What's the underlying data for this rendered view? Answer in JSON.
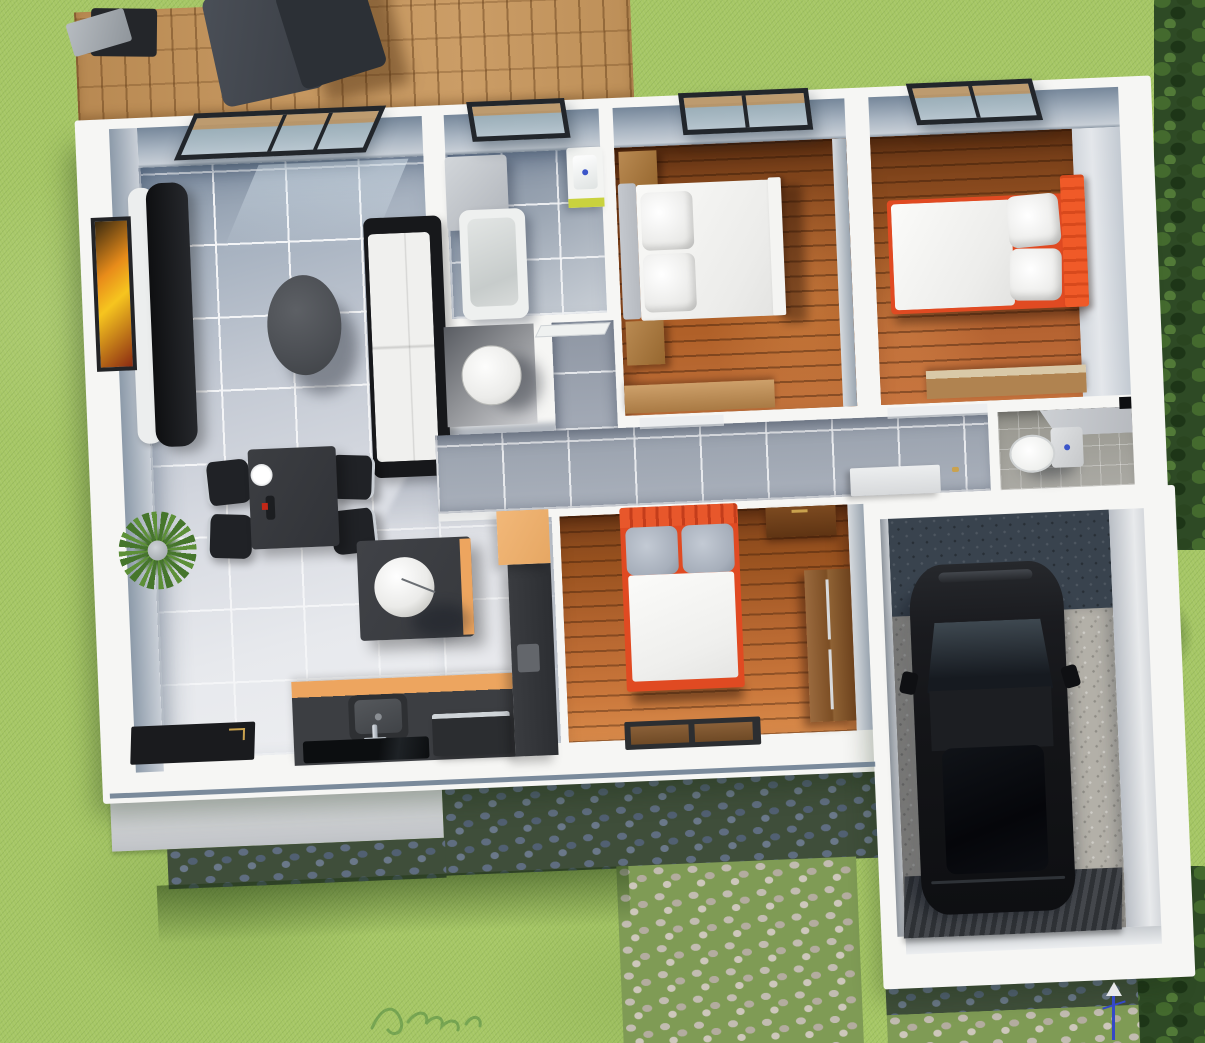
{
  "scene": {
    "kind": "3d-rendered-floor-plan",
    "view": "top-down",
    "watermark": {
      "present": true,
      "legible": false
    }
  },
  "colors": {
    "grass": "#a6c765",
    "grassShadow": "#4f7a33",
    "foliage": "#2e4a25",
    "deck": "#c3955e",
    "wallWhite": "#f6f6f4",
    "wallFace": "#b9c3cd",
    "wallEdge": "#5b6f84",
    "tileLight": "#e9ebee",
    "tileShade": "#8e9cac",
    "tileHall": "#9aa2ae",
    "grout": "#f4f5f7",
    "wood": "#a85a28",
    "woodDark": "#8a4a1f",
    "woodLight": "#cd8443",
    "woodBed3": "#b4652f",
    "furnDark": "#3a3c40",
    "black": "#17181b",
    "sofaWhite": "#f0f0ee",
    "cabinetOrange": "#f2b879",
    "counterOrange": "#eda55f",
    "bedRed": "#e04a22",
    "bedOrange": "#f05a28",
    "pillowGray": "#a7afbb",
    "headboardGray": "#b6bac0",
    "cobbleDarkStone": "#5f6d80",
    "cobbleDarkGap": "#3f4e3a",
    "cobbleLightStone": "#c2bcb1",
    "cobbleLightGap": "#7f9b55",
    "slab": "#d0d2d5",
    "garageDark": "#39434e",
    "gravel": "#b3b0a8",
    "glass": "#9fb3bb",
    "lime": "#c9d23e",
    "plantGreen": "#4e7d32",
    "toiletFloor": "#aaa9a3",
    "carBlack": "#141518"
  },
  "rooms": [
    {
      "name": "living-room",
      "floor": "gray-tile",
      "furniture": [
        "sliding-window",
        "tv-console",
        "media-shelf",
        "wall-art",
        "coffee-table",
        "sofa",
        "potted-plant",
        "floor-mat"
      ]
    },
    {
      "name": "dining-area",
      "floor": "gray-tile",
      "furniture": [
        "dining-table",
        "dining-chair",
        "dining-chair",
        "dining-chair",
        "dining-chair",
        "plate",
        "wine-bottle"
      ]
    },
    {
      "name": "kitchen",
      "floor": "gray-tile",
      "furniture": [
        "island",
        "sphere-lamp",
        "counter",
        "sink",
        "faucet",
        "cooktop",
        "dishwasher",
        "tall-cabinet",
        "orange-cabinet"
      ]
    },
    {
      "name": "bathroom",
      "floor": "gray-tile",
      "furniture": [
        "window",
        "shower-cabinet",
        "washbasin",
        "bathtub"
      ]
    },
    {
      "name": "laundry-room",
      "floor": "light",
      "furniture": [
        "washing-machine"
      ]
    },
    {
      "name": "corridor",
      "floor": "gray-tile",
      "furniture": [
        "door-leaf"
      ]
    },
    {
      "name": "hallway",
      "floor": "gray-tile",
      "furniture": [
        "sideboard-cabinet",
        "sliding-door",
        "sliding-door"
      ]
    },
    {
      "name": "bedroom-top-left",
      "floor": "wood",
      "furniture": [
        "window",
        "nightstand",
        "nightstand",
        "double-bed-white",
        "pillows",
        "desk"
      ]
    },
    {
      "name": "bedroom-top-right",
      "floor": "wood",
      "furniture": [
        "window",
        "double-bed-orange",
        "pillows",
        "desk"
      ]
    },
    {
      "name": "bedroom-bottom",
      "floor": "wood",
      "furniture": [
        "double-bed-red",
        "gray-pillows",
        "dresser",
        "wardrobe",
        "doormat"
      ]
    },
    {
      "name": "wc",
      "floor": "taupe-tile",
      "furniture": [
        "toilet",
        "light-switch"
      ]
    },
    {
      "name": "garage",
      "floor": "gravel",
      "furniture": [
        "car",
        "ribbed-ramp"
      ]
    }
  ],
  "exterior": [
    "lawn",
    "wood-deck",
    "deck-furniture",
    "hedge-right",
    "hedge-bottom-right",
    "concrete-pad",
    "cobblestone-driveway-shadowed",
    "cobblestone-path",
    "building-shadow",
    "garden-light",
    "watermark-squiggle"
  ]
}
